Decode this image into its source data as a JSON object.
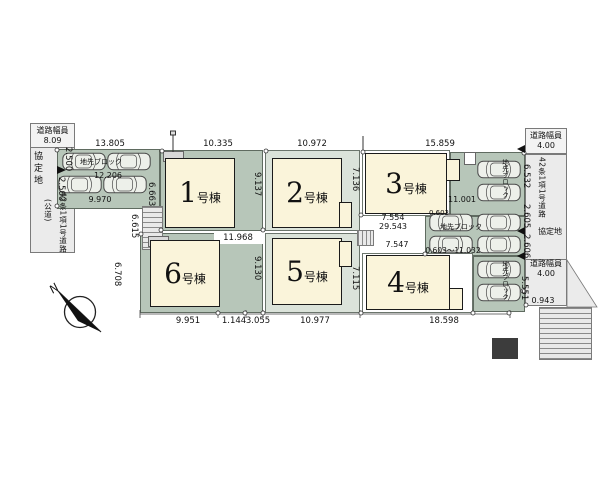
{
  "site": {
    "compass": "N",
    "left_road": {
      "width_label": "道路幅員",
      "width_value": "8.09",
      "agreement": "協定地",
      "setback1": "2.500",
      "setback2": "2.500",
      "name": "42条1項1号道路",
      "note": "(公道)"
    },
    "right_road": {
      "width_label": "道路幅員",
      "width_value": "4.00",
      "name": "42条1項1号道路",
      "agreement": "協定地",
      "d6532": "6.532",
      "d2605": "2.605",
      "d2606": "2.606",
      "d5551": "5.551",
      "d0943": "0.943"
    },
    "parking_top": {
      "curb": "地先ブロック",
      "d13805": "13.805",
      "d12206": "12.206",
      "d9970": "9.970"
    },
    "parking_right": {
      "curb": "地先ブロック",
      "curb_v": "地先ブロック",
      "d11001": "11.001",
      "d0603": "0.603",
      "drange": "0.603～11.032"
    },
    "aisle": {
      "d7554": "7.554",
      "d29543": "29.543",
      "d7547": "7.547",
      "d6615": "6.615"
    },
    "lots": [
      {
        "num": "1",
        "suffix": "号棟",
        "d_top": "10.335",
        "d_right": "9.137",
        "d_left": "6.663",
        "d_bottom": "11.968"
      },
      {
        "num": "2",
        "suffix": "号棟",
        "d_top": "10.972",
        "d_right": "7.136"
      },
      {
        "num": "3",
        "suffix": "号棟",
        "d_top": "15.859"
      },
      {
        "num": "4",
        "suffix": "号棟",
        "d_bottom": "18.598"
      },
      {
        "num": "5",
        "suffix": "号棟",
        "d_right": "7.115",
        "d_bottom": "10.977"
      },
      {
        "num": "6",
        "suffix": "号棟",
        "d_right": "9.130",
        "d_left": "6.708",
        "d_bottom1": "9.951",
        "d_bottom2": "1.144",
        "d_bottom3": "3.055"
      }
    ]
  },
  "colors": {
    "lot_green": "#b7c6b9",
    "lot_light_green": "#dbe3da",
    "building_cream": "#faf4da",
    "road_gray": "#ebebeb",
    "line": "#111111"
  }
}
